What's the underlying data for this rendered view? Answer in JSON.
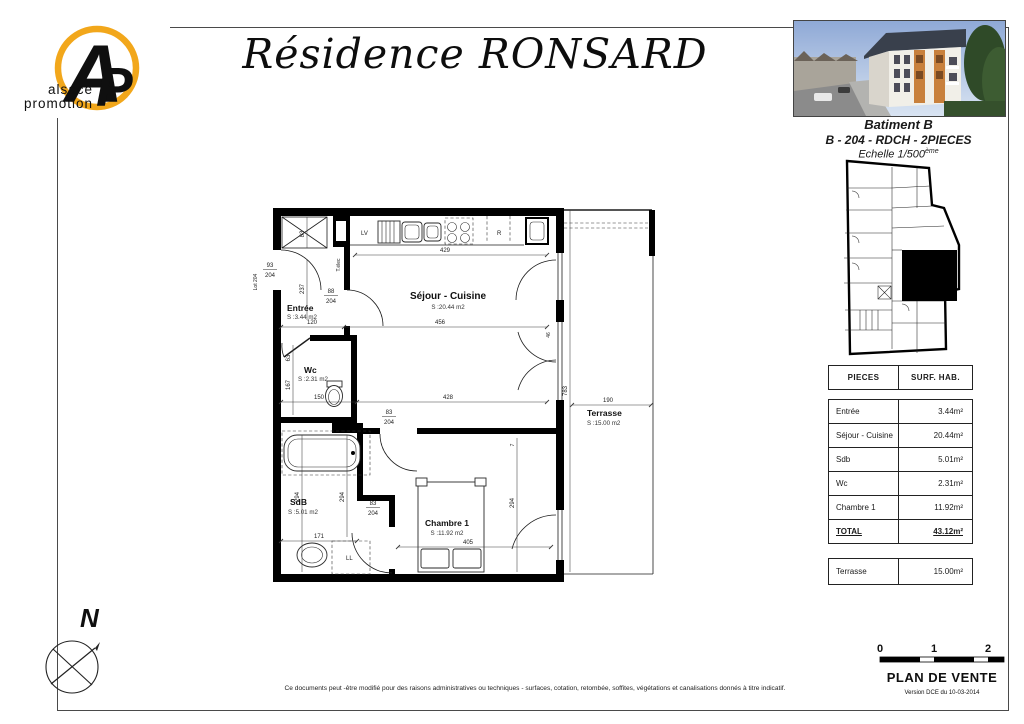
{
  "header": {
    "title": "Résidence RONSARD",
    "logo": {
      "monogram_a": "A",
      "monogram_p": "P",
      "line1": "alsace",
      "line2": "promotion"
    },
    "photo_caption": {
      "building": "Batiment B",
      "unit": "B - 204 - RDCH - 2PIECES",
      "scale": "Echelle 1/500",
      "scale_sup": "ème"
    }
  },
  "floorplan": {
    "rooms": [
      {
        "name": "Entrée",
        "area": "S :3.44 m2"
      },
      {
        "name": "Séjour - Cuisine",
        "area": "S :20.44 m2"
      },
      {
        "name": "Wc",
        "area": "S :2.31 m2"
      },
      {
        "name": "SdB",
        "area": "S :5.01 m2"
      },
      {
        "name": "Chambre 1",
        "area": "S :11.92 m2"
      },
      {
        "name": "Terrasse",
        "area": "S :15.00 m2"
      }
    ],
    "dims": {
      "kitchen_w": "429",
      "sejour_w": "456",
      "sejour_w2": "428",
      "entree_w": "120",
      "wc_w": "150",
      "sdb_w": "171",
      "chambre_w": "405",
      "terrasse_w": "190",
      "right_h": "783",
      "entree_h": "237",
      "wc_h": "167",
      "wc_top": "63",
      "closet": "83",
      "sdb_h1": "294",
      "sdb_h2": "294",
      "chambre_h": "294",
      "win": "46",
      "small": "7"
    },
    "doors": {
      "lot_label": "Lot 204",
      "lot_num": "93",
      "lot_den": "204",
      "entree_num": "88",
      "entree_den": "204",
      "chambre_num": "83",
      "chambre_den": "204",
      "sdb_num": "83",
      "sdb_den": "204"
    },
    "labels": {
      "lv": "LV",
      "r": "R",
      "ll": "LL",
      "telec": "T.élec"
    },
    "compass": "N"
  },
  "table": {
    "headers": [
      "PIECES",
      "SURF. HAB."
    ],
    "rows": [
      {
        "piece": "Entrée",
        "surface": "3.44m²"
      },
      {
        "piece": "Séjour - Cuisine",
        "surface": "20.44m²"
      },
      {
        "piece": "Sdb",
        "surface": "5.01m²"
      },
      {
        "piece": "Wc",
        "surface": "2.31m²"
      },
      {
        "piece": "Chambre 1",
        "surface": "11.92m²"
      }
    ],
    "total": {
      "piece": "TOTAL",
      "surface": "43.12m²"
    },
    "annex": {
      "piece": "Terrasse",
      "surface": "15.00m²"
    }
  },
  "footer": {
    "disclaimer": "Ce documents peut -être modifié pour des raisons administratives ou techniques - surfaces, cotation, retombée, soffites, végétations et canalisations donnés à titre indicatif.",
    "plan_title": "PLAN DE VENTE",
    "version": "Version DCE du 10-03-2014",
    "scale_ticks": [
      "0",
      "1",
      "2"
    ]
  }
}
